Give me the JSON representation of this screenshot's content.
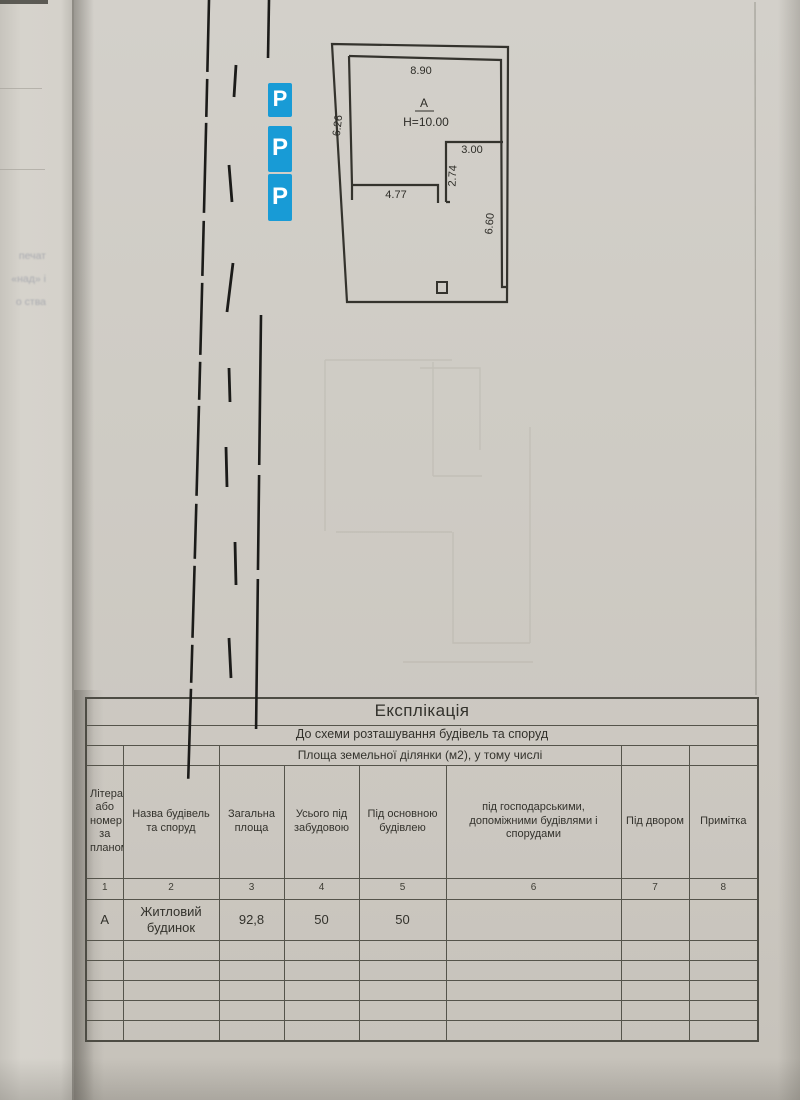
{
  "site_plan": {
    "dims": {
      "top": "8.90",
      "left": "6.26",
      "inner_bottom": "4.77",
      "step_vertical": "2.74",
      "step_top": "3.00",
      "right": "6.60"
    },
    "building_letter": "А",
    "building_height": "Н=10.00"
  },
  "parking": {
    "label": "P",
    "sign_count": 3,
    "color": "#189bd6"
  },
  "explication": {
    "title": "Експлікація",
    "subtitle": "До схеми розташування будівель та споруд",
    "area_span_header": "Площа земельної ділянки (м2), у тому числі",
    "headers": [
      "Літера або номер за планом",
      "Назва будівель та споруд",
      "Загальна площа",
      "Усього під забудовою",
      "Під основною будівлею",
      "під господарськими, допоміжними будівлями і спорудами",
      "Під двором",
      "Примітка"
    ],
    "column_numbers": [
      "1",
      "2",
      "3",
      "4",
      "5",
      "6",
      "7",
      "8"
    ],
    "data_rows": [
      [
        "А",
        "Житловий будинок",
        "92,8",
        "50",
        "50",
        "",
        "",
        ""
      ]
    ]
  },
  "underpage_fragments": [
    "печат",
    "«над» і",
    "о ства"
  ]
}
